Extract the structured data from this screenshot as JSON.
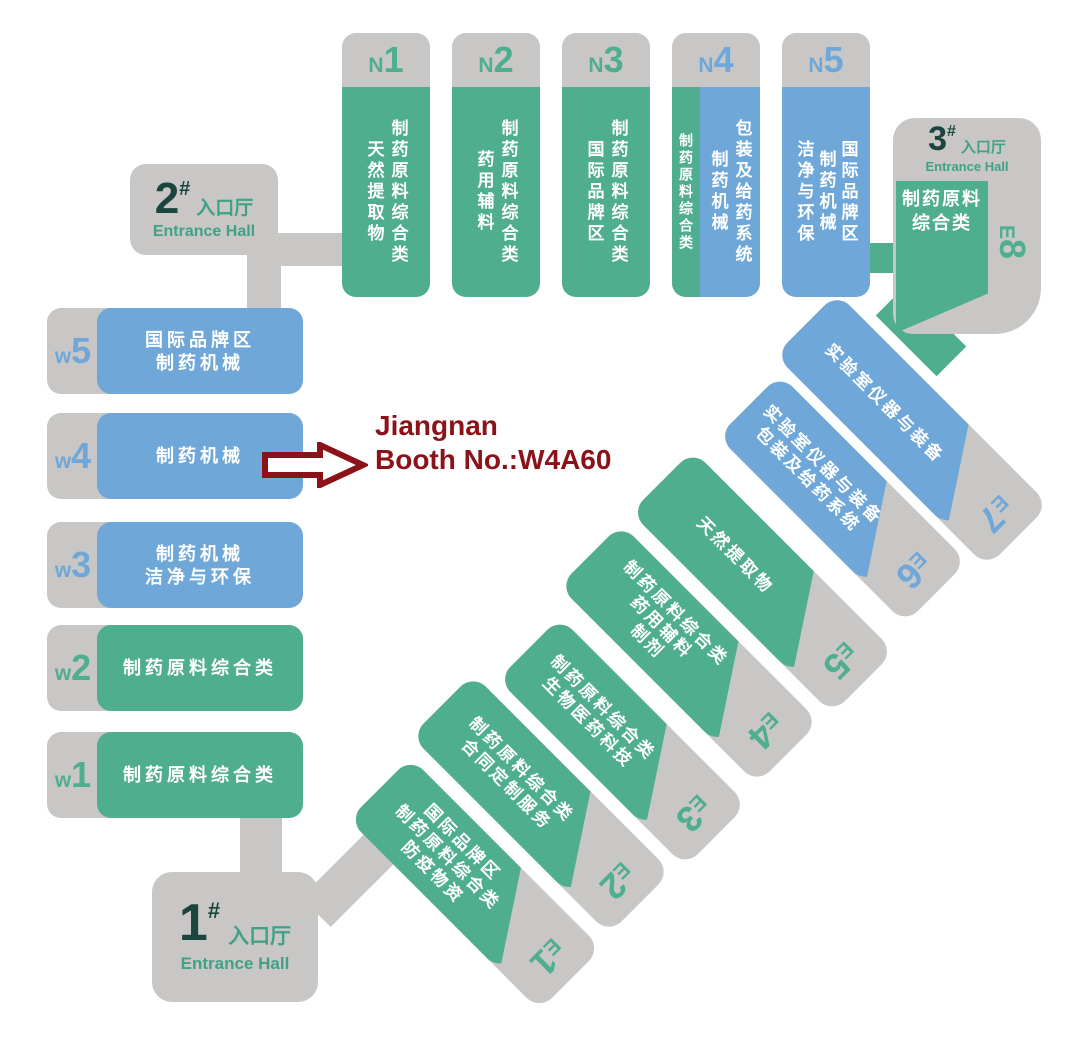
{
  "colors": {
    "hall_green": "#4fae8e",
    "hall_blue": "#6fa8d8",
    "gray": "#c8c7c5",
    "entrance_number_dark": "#1b453f",
    "entrance_green": "#3fa287",
    "annotation_red": "#8c1118",
    "background": "#ffffff",
    "hall_text": "#ffffff"
  },
  "entrances": [
    {
      "number": "1",
      "hash": "#",
      "label_cn": "入口厅",
      "label_en": "Entrance Hall"
    },
    {
      "number": "2",
      "hash": "#",
      "label_cn": "入口厅",
      "label_en": "Entrance Hall"
    },
    {
      "number": "3",
      "hash": "#",
      "label_cn": "入口厅",
      "label_en": "Entrance Hall"
    }
  ],
  "halls_n": [
    {
      "letter": "N",
      "number": "1",
      "color": "green",
      "columns": [
        "制药原料综合类",
        "天然提取物"
      ]
    },
    {
      "letter": "N",
      "number": "2",
      "color": "green",
      "columns": [
        "制药原料综合类",
        "药用辅料"
      ]
    },
    {
      "letter": "N",
      "number": "3",
      "color": "green",
      "columns": [
        "制药原料综合类",
        "国际品牌区"
      ]
    },
    {
      "letter": "N",
      "number": "4",
      "color": "split",
      "green_column": "制药原料综合类",
      "columns": [
        "包装及给药系统",
        "制药机械"
      ]
    },
    {
      "letter": "N",
      "number": "5",
      "color": "blue",
      "columns": [
        "国际品牌区",
        "制药机械",
        "洁净与环保"
      ]
    }
  ],
  "halls_w": [
    {
      "letter": "w",
      "number": "5",
      "color": "blue",
      "lines": [
        "国际品牌区",
        "制药机械"
      ]
    },
    {
      "letter": "w",
      "number": "4",
      "color": "blue",
      "lines": [
        "制药机械"
      ]
    },
    {
      "letter": "w",
      "number": "3",
      "color": "blue",
      "lines": [
        "制药机械",
        "洁净与环保"
      ]
    },
    {
      "letter": "w",
      "number": "2",
      "color": "green",
      "lines": [
        "制药原料综合类"
      ]
    },
    {
      "letter": "w",
      "number": "1",
      "color": "green",
      "lines": [
        "制药原料综合类"
      ]
    }
  ],
  "halls_e": [
    {
      "letter": "E",
      "number": "1",
      "color": "green",
      "lines": [
        "国际品牌区",
        "制药原料综合类",
        "防疫物资"
      ]
    },
    {
      "letter": "E",
      "number": "2",
      "color": "green",
      "lines": [
        "制药原料综合类",
        "合同定制服务"
      ]
    },
    {
      "letter": "E",
      "number": "3",
      "color": "green",
      "lines": [
        "制药原料综合类",
        "生物医药科技"
      ]
    },
    {
      "letter": "E",
      "number": "4",
      "color": "green",
      "lines": [
        "制药原料综合类",
        "药用辅料",
        "制剂"
      ]
    },
    {
      "letter": "E",
      "number": "5",
      "color": "green",
      "lines": [
        "天然提取物"
      ]
    },
    {
      "letter": "E",
      "number": "6",
      "color": "blue",
      "lines": [
        "实验室仪器与装备",
        "包装及给药系统"
      ]
    },
    {
      "letter": "E",
      "number": "7",
      "color": "blue",
      "lines": [
        "实验室仪器与装备"
      ]
    },
    {
      "letter": "E",
      "number": "8",
      "color": "green",
      "lines": [
        "制药原料",
        "综合类"
      ]
    }
  ],
  "annotation": {
    "company": "Jiangnan",
    "booth": "Booth No.:W4A60"
  }
}
